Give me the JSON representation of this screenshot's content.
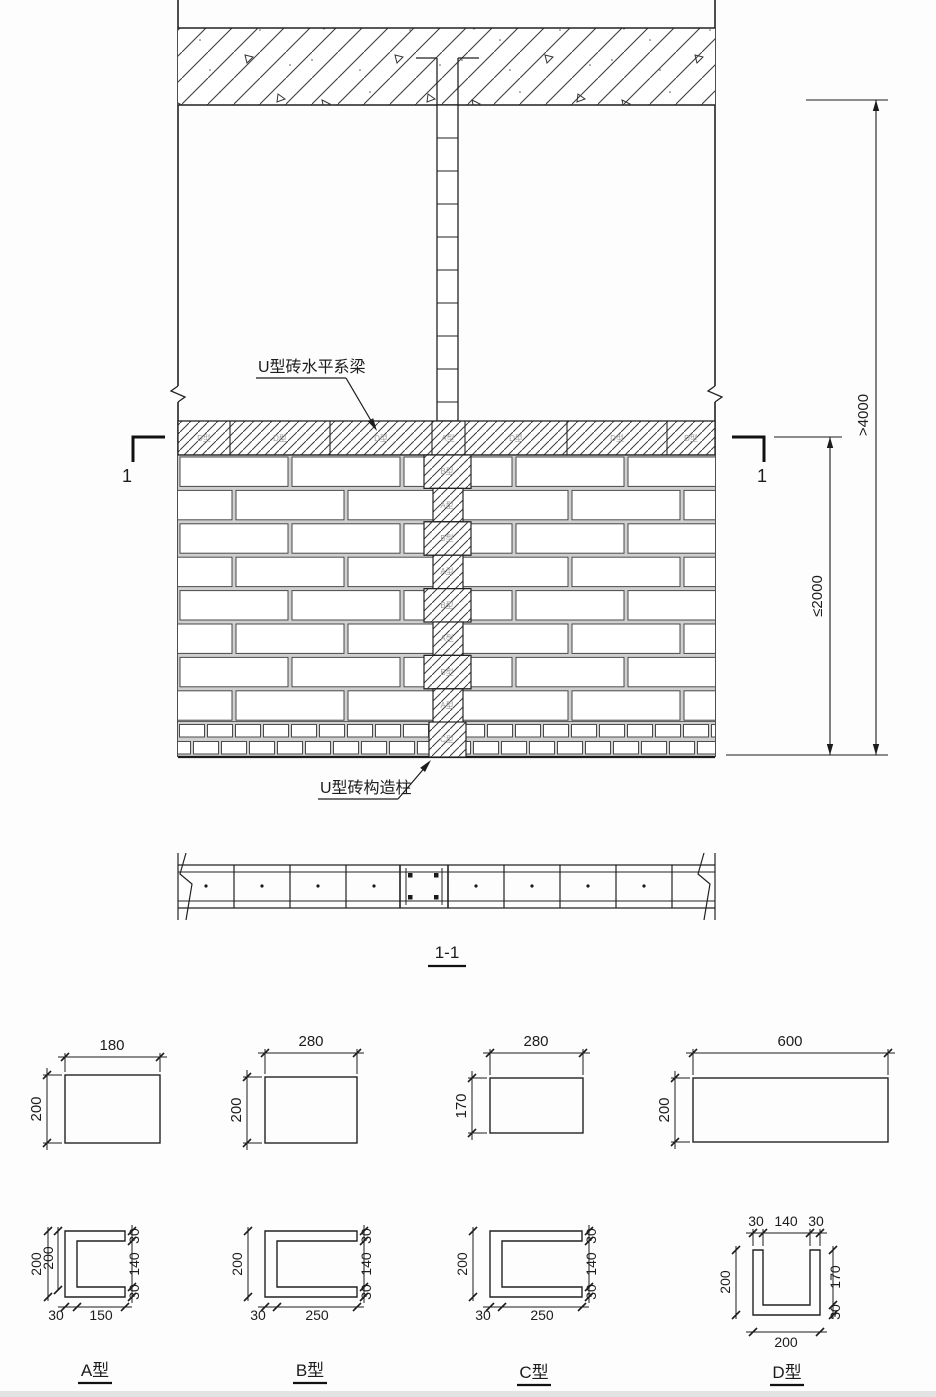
{
  "elevation": {
    "tie_beam_label": "U型砖水平系梁",
    "column_label": "U型砖构造柱",
    "section_cut_number_left": "1",
    "section_cut_number_right": "1",
    "dim_overall_height": ">4000",
    "dim_column_spacing": "≤2000",
    "beam_blocks": [
      "D型",
      "D型",
      "D型",
      "A型",
      "D型",
      "D型",
      "D型"
    ],
    "column_blocks": [
      "B型",
      "A型",
      "B型",
      "A型",
      "B型",
      "A型",
      "B型",
      "A型",
      "C型"
    ]
  },
  "section_view": {
    "label": "1-1"
  },
  "details": {
    "a": {
      "label": "A型",
      "plan": {
        "width": "180",
        "height": "200"
      },
      "u": {
        "left_outer": "200",
        "left_inner": "200",
        "bottom_wall": "30",
        "bottom_opening": "150",
        "right_top": "30",
        "right_mid": "140",
        "right_bottom": "30"
      }
    },
    "b": {
      "label": "B型",
      "plan": {
        "width": "280",
        "height": "200"
      },
      "u": {
        "left": "200",
        "bottom_wall": "30",
        "bottom_opening": "250",
        "right_top": "30",
        "right_mid": "140",
        "right_bottom": "30"
      }
    },
    "c": {
      "label": "C型",
      "plan": {
        "width": "280",
        "height": "170"
      },
      "u": {
        "left": "200",
        "bottom_wall": "30",
        "bottom_opening": "250",
        "right_top": "30",
        "right_mid": "140",
        "right_bottom": "30"
      }
    },
    "d": {
      "label": "D型",
      "plan": {
        "width": "600",
        "height": "200"
      },
      "u": {
        "top_left": "30",
        "top_mid": "140",
        "top_right": "30",
        "left": "200",
        "right_upper": "170",
        "right_lower": "30",
        "bottom": "200"
      }
    }
  }
}
